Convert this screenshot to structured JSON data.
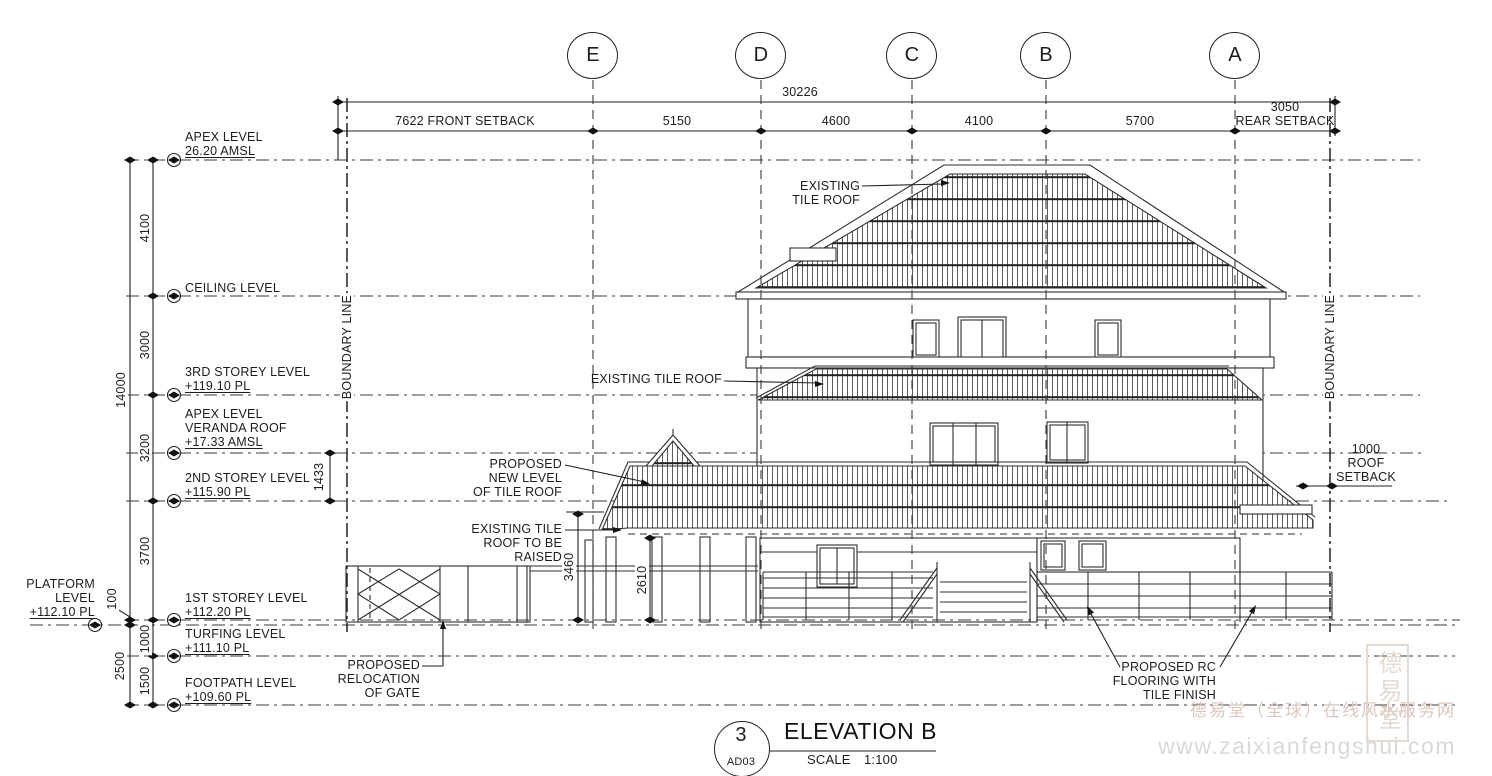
{
  "grid_bubbles": {
    "e": "E",
    "d": "D",
    "c": "C",
    "b": "B",
    "a": "A"
  },
  "dims_top": {
    "overall": "30226",
    "d1": "7622 FRONT SETBACK",
    "d2": "5150",
    "d3": "4600",
    "d4": "4100",
    "d5": "5700",
    "d6a": "3050",
    "d6b": "REAR SETBACK"
  },
  "levels": {
    "apex": {
      "l1": "APEX LEVEL",
      "l2": "26.20 AMSL"
    },
    "ceiling": {
      "l1": "CEILING LEVEL"
    },
    "storey3": {
      "l1": "3RD STOREY LEVEL",
      "l2": "+119.10 PL"
    },
    "veranda": {
      "l1": "APEX LEVEL",
      "l2": "VERANDA ROOF",
      "l3": "+17.33 AMSL"
    },
    "storey2": {
      "l1": "2ND STOREY LEVEL",
      "l2": "+115.90 PL"
    },
    "platform": {
      "l1": "PLATFORM",
      "l2": "LEVEL",
      "l3": "+112.10 PL"
    },
    "storey1": {
      "l1": "1ST STOREY LEVEL",
      "l2": "+112.20 PL"
    },
    "turfing": {
      "l1": "TURFING LEVEL",
      "l2": "+111.10 PL"
    },
    "footpath": {
      "l1": "FOOTPATH LEVEL",
      "l2": "+109.60 PL"
    }
  },
  "dims_vertical": {
    "total": "14000",
    "a": "4100",
    "b": "3000",
    "c": "3200",
    "d": "3700",
    "e": "100",
    "f": "1000",
    "g": "1500",
    "h": "2500",
    "i": "1433",
    "j": "3460",
    "k": "2610"
  },
  "boundary": {
    "left": "BOUNDARY LINE",
    "right": "BOUNDARY LINE"
  },
  "annotations": {
    "roof_top": {
      "l1": "EXISTING",
      "l2": "TILE ROOF"
    },
    "roof_mid": {
      "l1": "EXISTING TILE ROOF"
    },
    "roof_new": {
      "l1": "PROPOSED",
      "l2": "NEW LEVEL",
      "l3": "OF TILE ROOF"
    },
    "roof_raised": {
      "l1": "EXISTING TILE",
      "l2": "ROOF TO BE",
      "l3": "RAISED"
    },
    "gate": {
      "l1": "PROPOSED",
      "l2": "RELOCATION",
      "l3": "OF GATE"
    },
    "rc_floor": {
      "l1": "PROPOSED RC",
      "l2": "FLOORING WITH",
      "l3": "TILE FINISH"
    },
    "roof_setback": {
      "l1": "1000",
      "l2": "ROOF",
      "l3": "SETBACK"
    }
  },
  "title_block": {
    "number": "3",
    "sheet": "AD03",
    "title": "ELEVATION B",
    "scale_label": "SCALE",
    "scale_value": "1:100"
  },
  "watermark": {
    "seal": "德易堂",
    "line1": "德易堂（全球）在线风水服务网",
    "line2": "www.zaixianfengshui.com"
  }
}
